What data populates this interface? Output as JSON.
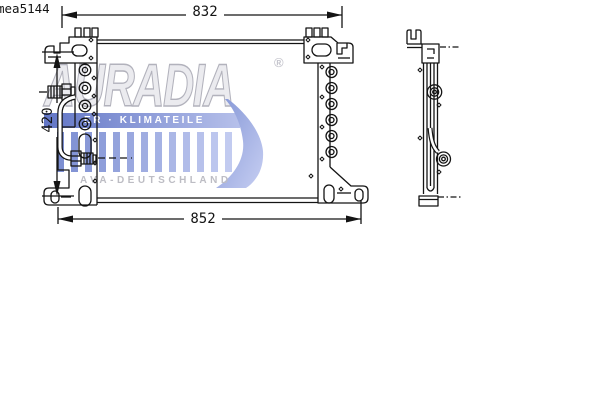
{
  "part_code": "mea5144",
  "dimensions": {
    "top_width": "832",
    "bottom_width": "852",
    "height": "420"
  },
  "views": {
    "front_label": "front-view-condenser",
    "side_label": "side-profile-view"
  },
  "watermark": {
    "brand": "AURADIA",
    "registered_mark": "®",
    "band_text": "ER · KLIMATEILE",
    "footer_text": "AVA-DEUTSCHLAND",
    "bar_count": 13,
    "colors": {
      "band_start": "#6276c6",
      "band_end": "#b6c0ea",
      "bar_start": "#7d8fd2",
      "bar_end": "#c2cbf0",
      "swoosh_start": "#8496d6",
      "swoosh_end": "#c6cef2",
      "brand_fill": "#ebebef",
      "brand_outline": "#b2b2bc",
      "gray_text": "#bdbdc4"
    }
  },
  "drawing": {
    "line_color": "#141414",
    "background": "#ffffff"
  }
}
